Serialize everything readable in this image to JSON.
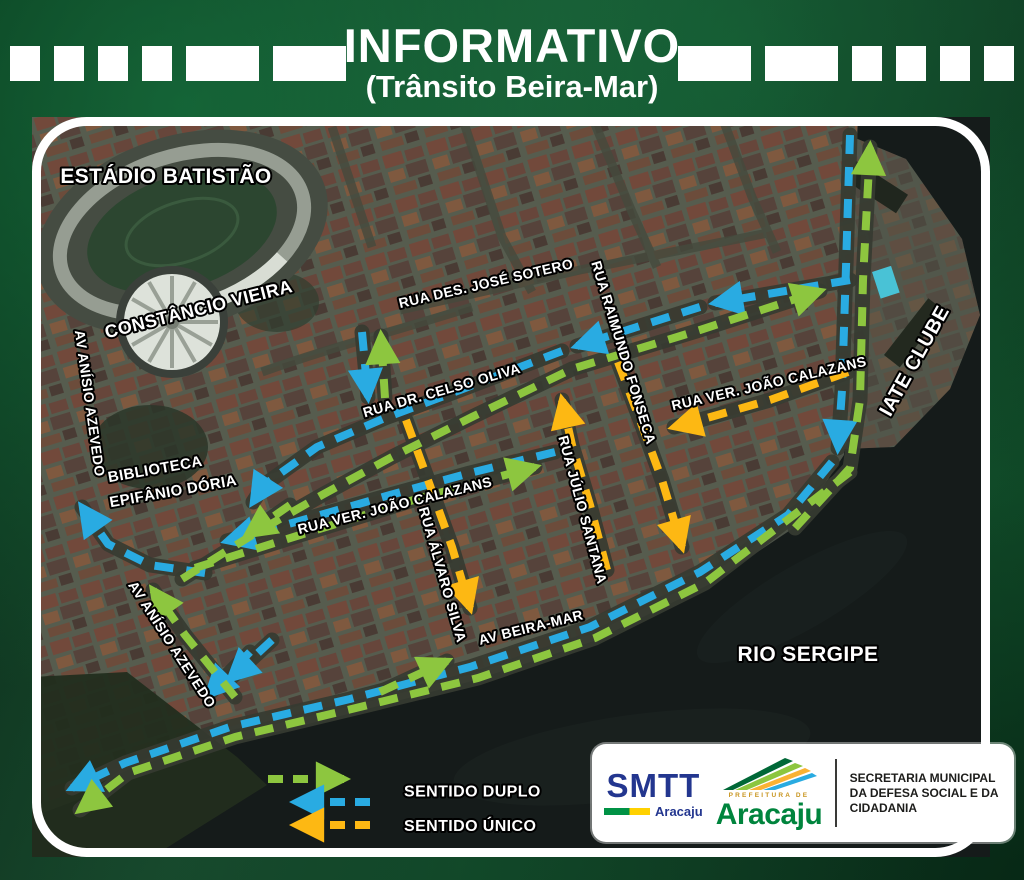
{
  "header": {
    "title": "INFORMATIVO",
    "subtitle": "(Trânsito Beira-Mar)"
  },
  "colors": {
    "duplo_green": "#8dc63f",
    "duplo_blue": "#29abe2",
    "unico_yellow": "#fdb813",
    "frame_green": "#0a3a1f"
  },
  "map": {
    "labels": [
      {
        "id": "estadio-batistao",
        "text": "ESTÁDIO BATISTÃO",
        "x": 134,
        "y": 66,
        "rotate": 0,
        "size": 21
      },
      {
        "id": "constancio-vieira",
        "text": "CONSTÂNCIO VIEIRA",
        "x": 168,
        "y": 198,
        "rotate": -14,
        "size": 18
      },
      {
        "id": "av-anisio-azevedo-norte",
        "text": "AV ANÍSIO AZEVEDO",
        "x": 53,
        "y": 287,
        "rotate": 82,
        "size": 14
      },
      {
        "id": "biblioteca-linha1",
        "text": "BIBLIOTECA",
        "x": 124,
        "y": 357,
        "rotate": -10,
        "size": 15
      },
      {
        "id": "biblioteca-linha2",
        "text": "EPIFÂNIO DÓRIA",
        "x": 142,
        "y": 379,
        "rotate": -10,
        "size": 15
      },
      {
        "id": "rua-des-jose-sotero",
        "text": "RUA DES. JOSÉ SOTERO",
        "x": 455,
        "y": 171,
        "rotate": -13,
        "size": 14
      },
      {
        "id": "rua-raimundo-fonseca",
        "text": "RUA RAIMUNDO FONSECA",
        "x": 587,
        "y": 237,
        "rotate": 73,
        "size": 14
      },
      {
        "id": "rua-dr-celso-oliva",
        "text": "RUA DR. CELSO OLIVA",
        "x": 411,
        "y": 278,
        "rotate": -16,
        "size": 14
      },
      {
        "id": "rua-ver-joao-calazans-leste",
        "text": "RUA VER. JOÃO CALAZANS",
        "x": 738,
        "y": 271,
        "rotate": -13,
        "size": 14
      },
      {
        "id": "iate-clube",
        "text": "IATE CLUBE",
        "x": 888,
        "y": 247,
        "rotate": -61,
        "size": 20
      },
      {
        "id": "rua-ver-joao-calazans-oeste",
        "text": "RUA VER. JOÃO CALAZANS",
        "x": 364,
        "y": 393,
        "rotate": -14,
        "size": 14
      },
      {
        "id": "rua-alvaro-silva",
        "text": "RUA ÁLVARO SILVA",
        "x": 406,
        "y": 459,
        "rotate": 74,
        "size": 14
      },
      {
        "id": "rua-julio-santana",
        "text": "RUA JÚLIO SANTANA",
        "x": 546,
        "y": 394,
        "rotate": 75,
        "size": 14
      },
      {
        "id": "av-beira-mar",
        "text": "AV BEIRA-MAR",
        "x": 500,
        "y": 515,
        "rotate": -14,
        "size": 14
      },
      {
        "id": "av-anisio-azevedo-sul",
        "text": "AV ANÍSIO AZEVEDO",
        "x": 136,
        "y": 530,
        "rotate": 57,
        "size": 14
      },
      {
        "id": "rio-sergipe",
        "text": "RIO SERGIPE",
        "x": 776,
        "y": 544,
        "rotate": 0,
        "size": 21
      }
    ],
    "routes": [
      {
        "name": "iate-descida",
        "kind": "duplo-blue",
        "points": [
          [
            818,
            18
          ],
          [
            814,
            150
          ],
          [
            810,
            273
          ],
          [
            806,
            331
          ]
        ]
      },
      {
        "name": "beira-mar-descida",
        "kind": "duplo-blue",
        "points": [
          [
            800,
            345
          ],
          [
            756,
            398
          ],
          [
            668,
            455
          ],
          [
            558,
            510
          ],
          [
            438,
            550
          ],
          [
            318,
            582
          ],
          [
            198,
            610
          ],
          [
            93,
            646
          ],
          [
            40,
            671
          ]
        ]
      },
      {
        "name": "celso-oliva-oeste-a",
        "kind": "duplo-blue",
        "points": [
          [
            818,
            163
          ],
          [
            683,
            186
          ]
        ]
      },
      {
        "name": "celso-oliva-oeste-b",
        "kind": "duplo-blue",
        "points": [
          [
            668,
            190
          ],
          [
            545,
            229
          ]
        ]
      },
      {
        "name": "celso-oliva-oeste-c",
        "kind": "duplo-blue",
        "points": [
          [
            530,
            234
          ],
          [
            428,
            273
          ],
          [
            353,
            301
          ],
          [
            285,
            330
          ],
          [
            232,
            368
          ],
          [
            221,
            385
          ]
        ]
      },
      {
        "name": "calazans-oeste",
        "kind": "duplo-blue",
        "points": [
          [
            523,
            335
          ],
          [
            438,
            356
          ],
          [
            358,
            378
          ],
          [
            278,
            401
          ],
          [
            195,
            424
          ]
        ]
      },
      {
        "name": "sotero-conector-sul",
        "kind": "duplo-blue",
        "points": [
          [
            330,
            215
          ],
          [
            336,
            280
          ]
        ]
      },
      {
        "name": "anisio-subida",
        "kind": "duplo-blue",
        "points": [
          [
            173,
            456
          ],
          [
            118,
            448
          ],
          [
            76,
            427
          ],
          [
            50,
            390
          ]
        ]
      },
      {
        "name": "hub-sul-a",
        "kind": "duplo-blue",
        "points": [
          [
            218,
            535
          ],
          [
            176,
            578
          ]
        ]
      },
      {
        "name": "hub-sul-b",
        "kind": "duplo-blue",
        "points": [
          [
            240,
            523
          ],
          [
            198,
            562
          ]
        ]
      },
      {
        "name": "iate-subida",
        "kind": "duplo-green",
        "points": [
          [
            763,
            411
          ],
          [
            818,
            351
          ],
          [
            828,
            283
          ],
          [
            831,
            163
          ],
          [
            838,
            30
          ]
        ]
      },
      {
        "name": "beira-mar-nordeste",
        "kind": "duplo-green",
        "points": [
          [
            348,
            575
          ],
          [
            415,
            544
          ]
        ]
      },
      {
        "name": "beira-mar-externa",
        "kind": "duplo-green",
        "points": [
          [
            818,
            355
          ],
          [
            673,
            466
          ],
          [
            563,
            521
          ],
          [
            446,
            561
          ],
          [
            328,
            590
          ],
          [
            203,
            620
          ],
          [
            96,
            656
          ],
          [
            48,
            693
          ]
        ]
      },
      {
        "name": "celso-oliva-leste",
        "kind": "duplo-green",
        "points": [
          [
            150,
            462
          ],
          [
            225,
            415
          ],
          [
            290,
            378
          ],
          [
            360,
            340
          ],
          [
            440,
            300
          ],
          [
            540,
            252
          ],
          [
            668,
            213
          ],
          [
            788,
            174
          ]
        ]
      },
      {
        "name": "calazans-leste",
        "kind": "duplo-green",
        "points": [
          [
            163,
            451
          ],
          [
            268,
            418
          ],
          [
            388,
            381
          ],
          [
            503,
            350
          ]
        ]
      },
      {
        "name": "sotero-conector-norte",
        "kind": "duplo-green",
        "points": [
          [
            353,
            281
          ],
          [
            349,
            219
          ]
        ]
      },
      {
        "name": "anisio-hub-norte",
        "kind": "duplo-green",
        "points": [
          [
            203,
            580
          ],
          [
            153,
            518
          ],
          [
            121,
            473
          ]
        ]
      },
      {
        "name": "hub-oeste",
        "kind": "duplo-green",
        "points": [
          [
            258,
            388
          ],
          [
            215,
            418
          ]
        ]
      },
      {
        "name": "raimundo-fonseca",
        "kind": "unico-yellow",
        "points": [
          [
            586,
            245
          ],
          [
            608,
            303
          ],
          [
            630,
            363
          ],
          [
            650,
            430
          ]
        ]
      },
      {
        "name": "julio-santana",
        "kind": "unico-yellow",
        "points": [
          [
            575,
            453
          ],
          [
            558,
            388
          ],
          [
            540,
            328
          ],
          [
            530,
            283
          ]
        ]
      },
      {
        "name": "alvaro-silva",
        "kind": "unico-yellow",
        "points": [
          [
            374,
            303
          ],
          [
            396,
            363
          ],
          [
            420,
            430
          ],
          [
            438,
            491
          ]
        ]
      },
      {
        "name": "calazans-leste-unico",
        "kind": "unico-yellow",
        "points": [
          [
            816,
            255
          ],
          [
            738,
            283
          ],
          [
            668,
            303
          ],
          [
            642,
            310
          ]
        ]
      }
    ]
  },
  "legend": {
    "items": [
      {
        "label": "SENTIDO DUPLO",
        "arrows": [
          {
            "color": "green",
            "dir": "right"
          },
          {
            "color": "blue",
            "dir": "left"
          }
        ]
      },
      {
        "label": "SENTIDO ÚNICO",
        "arrows": [
          {
            "color": "yellow",
            "dir": "left"
          }
        ]
      }
    ]
  },
  "footer": {
    "smtt": {
      "name": "SMTT",
      "city": "Aracaju"
    },
    "prefeitura": {
      "small": "PREFEITURA DE",
      "name": "Aracaju"
    },
    "secretaria": {
      "line1": "SECRETARIA MUNICIPAL",
      "line2": "DA DEFESA SOCIAL E DA CIDADANIA"
    }
  }
}
